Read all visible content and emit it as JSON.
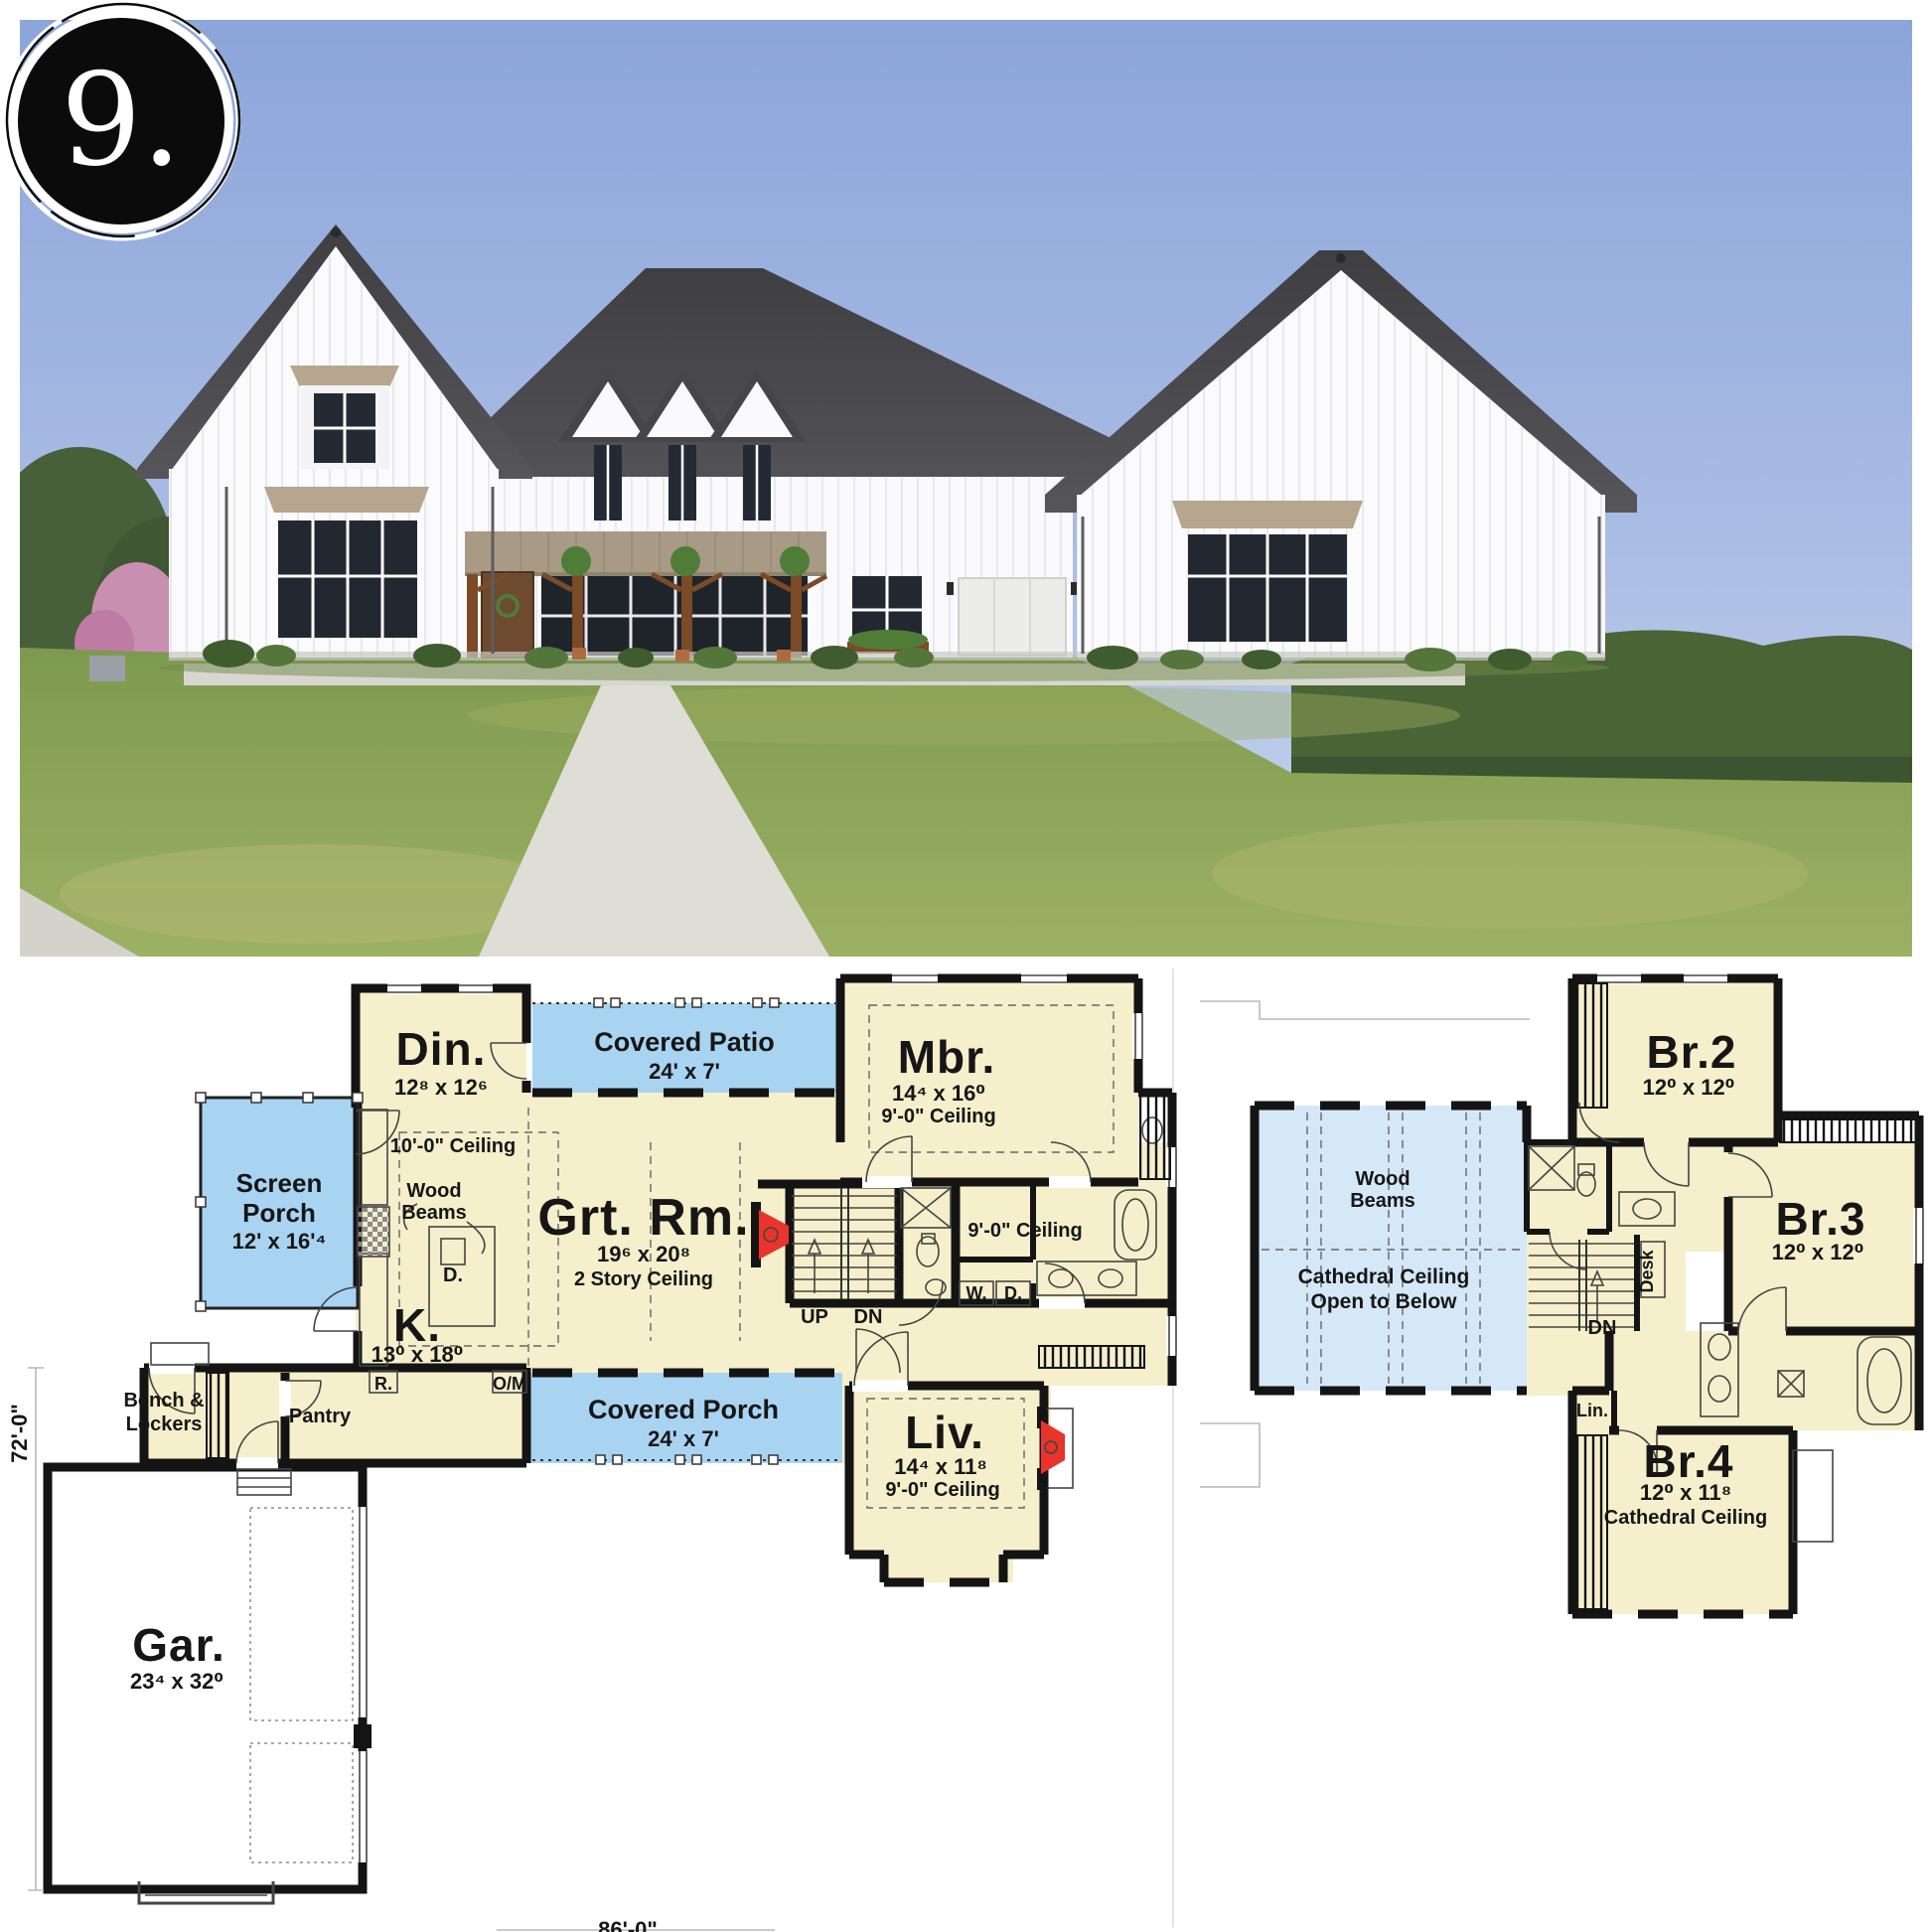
{
  "badge": {
    "number": "9."
  },
  "colors": {
    "room_fill": "#F6EFCB",
    "porch_blue": "#A9D4F1",
    "open_below_blue": "#D5E8F8",
    "fireplace_red": "#E8342A",
    "wall_black": "#141414",
    "sky_blue": "#8CA5DA",
    "grass_green": "#8AA457",
    "roof_gray": "#48484B",
    "awning_tan": "#B5A68D"
  },
  "floor1": {
    "din_label": "Din.",
    "din_dims": "12⁸ x 12⁶",
    "patio_label": "Covered Patio",
    "patio_dims": "24' x 7'",
    "mbr_label": "Mbr.",
    "mbr_dims": "14⁴ x 16⁰",
    "mbr_ceiling": "9'-0\" Ceiling",
    "screen_line1": "Screen",
    "screen_line2": "Porch",
    "screen_dims": "12' x 16'⁴",
    "kitchen_ceiling": "10'-0\" Ceiling",
    "wood_line1": "Wood",
    "wood_line2": "Beams",
    "dw": "D.",
    "grt_label": "Grt. Rm.",
    "grt_dims": "19⁶ x 20⁸",
    "grt_ceiling": "2 Story Ceiling",
    "k_label": "K.",
    "k_dims": "13⁰ x 18⁰",
    "fridge": "R.",
    "om": "O/M",
    "up": "UP",
    "dn": "DN",
    "bath_ceiling": "9'-0\" Ceiling",
    "washer": "W.",
    "dryer": "D.",
    "bench_line1": "Bench &",
    "bench_line2": "Lockers",
    "pantry": "Pantry",
    "porch_label": "Covered Porch",
    "porch_dims": "24' x 7'",
    "liv_label": "Liv.",
    "liv_dims": "14⁴ x 11⁸",
    "liv_ceiling": "9'-0\" Ceiling",
    "gar_label": "Gar.",
    "gar_dims": "23⁴ x 32⁰",
    "dim_depth": "72'-0\"",
    "dim_width": "86'-0\""
  },
  "floor2": {
    "br2_label": "Br.2",
    "br2_dims": "12⁰ x 12⁰",
    "br3_label": "Br.3",
    "br3_dims": "12⁰ x 12⁰",
    "br4_label": "Br.4",
    "br4_dims": "12⁰ x 11⁸",
    "br4_ceiling": "Cathedral Ceiling",
    "wood_line1": "Wood",
    "wood_line2": "Beams",
    "open_line1": "Cathedral Ceiling",
    "open_line2": "Open to Below",
    "desk": "Desk",
    "dn": "DN",
    "lin": "Lin."
  }
}
